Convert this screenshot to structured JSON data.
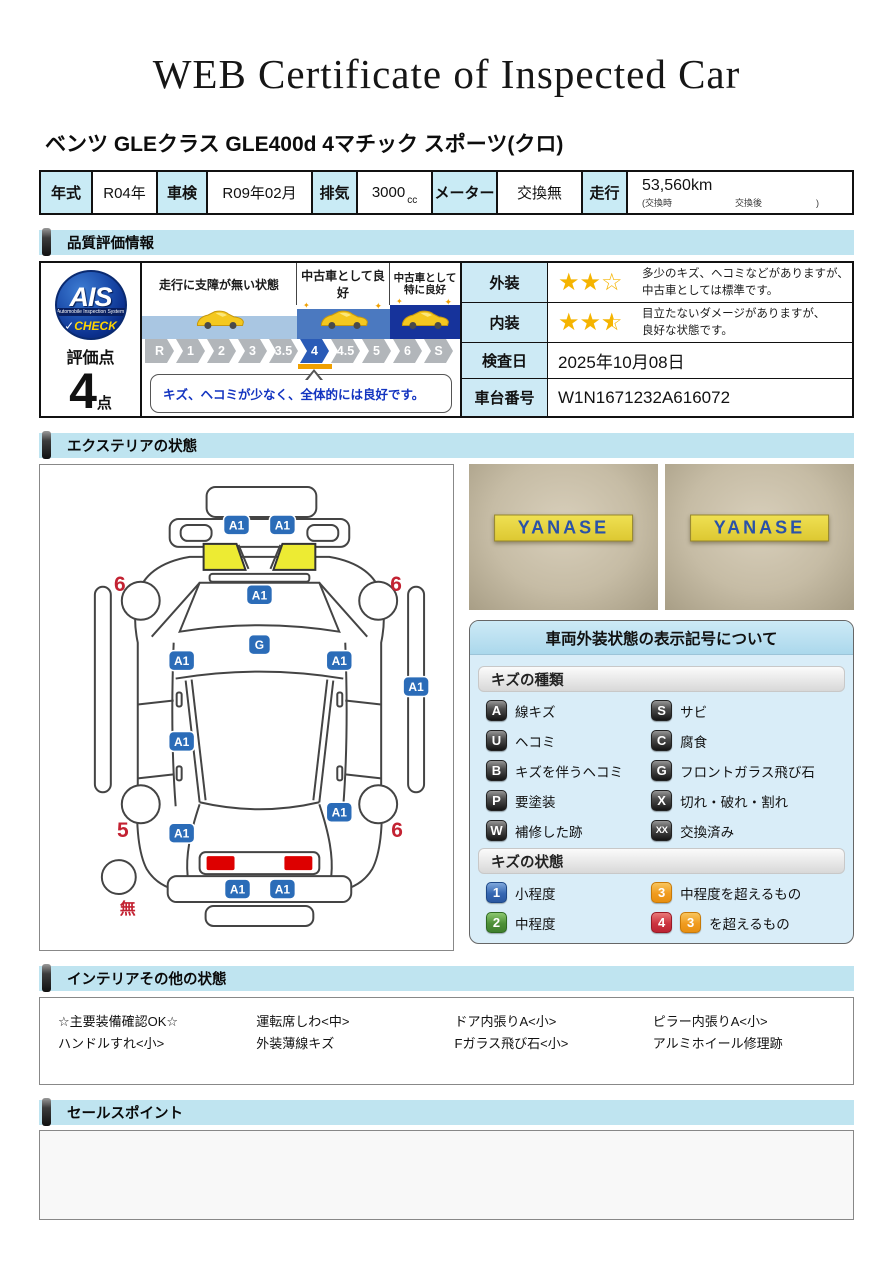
{
  "page": {
    "title": "WEB Certificate of Inspected Car",
    "car_name": "ベンツ GLEクラス GLE400d 4マチック スポーツ(クロ)"
  },
  "spec": {
    "cells": [
      {
        "label": "年式",
        "value": "R04年"
      },
      {
        "label": "車検",
        "value": "R09年02月"
      },
      {
        "label": "排気",
        "value": "3000",
        "unit": "cc"
      },
      {
        "label": "メーター",
        "value": "交換無"
      },
      {
        "label": "走行",
        "value": "53,560km",
        "note": "(交換時　　　　　　　交換後　　　　　　)"
      }
    ]
  },
  "sections": {
    "quality": "品質評価情報",
    "exterior": "エクステリアの状態",
    "interior": "インテリアその他の状態",
    "sales": "セールスポイント"
  },
  "quality": {
    "logo": {
      "main": "AIS",
      "sub": "Automobile Inspection System",
      "checkmark": "✓",
      "check": "CHECK"
    },
    "score_label": "評価点",
    "score_value": "4",
    "score_unit": "点",
    "zones": [
      {
        "label": "走行に支障が無い状態"
      },
      {
        "label": "中古車として良好"
      },
      {
        "label1": "中古車として",
        "label2": "特に良好"
      }
    ],
    "scale": [
      "R",
      "1",
      "2",
      "3",
      "3.5",
      "4",
      "4.5",
      "5",
      "6",
      "S"
    ],
    "scale_active": "4",
    "comment": "キズ、ヘコミが少なく、全体的には良好です。",
    "rows": [
      {
        "label": "外装",
        "stars_filled": 2,
        "stars_empty": 1,
        "text1": "多少のキズ、ヘコミなどがありますが、",
        "text2": "中古車としては標準です。"
      },
      {
        "label": "内装",
        "stars_filled": 2,
        "stars_half": 1,
        "text1": "目立たないダメージがありますが、",
        "text2": "良好な状態です。"
      },
      {
        "label": "検査日",
        "value": "2025年10月08日"
      },
      {
        "label": "車台番号",
        "value": "W1N1671232A616072"
      }
    ]
  },
  "exterior": {
    "photos": {
      "sign": "YANASE"
    },
    "diagram": {
      "badge_a1": "A1",
      "badge_g": "G",
      "wheel_rear_left": "6",
      "wheel_rear_right": "6",
      "wheel_front_left": "5",
      "wheel_front_right": "6",
      "spare": "無"
    },
    "legend": {
      "title": "車両外装状態の表示記号について",
      "kind_header": "キズの種類",
      "kinds": [
        {
          "code": "A",
          "label": "線キズ"
        },
        {
          "code": "S",
          "label": "サビ"
        },
        {
          "code": "U",
          "label": "ヘコミ"
        },
        {
          "code": "C",
          "label": "腐食"
        },
        {
          "code": "B",
          "label": "キズを伴うヘコミ"
        },
        {
          "code": "G",
          "label": "フロントガラス飛び石"
        },
        {
          "code": "P",
          "label": "要塗装"
        },
        {
          "code": "X",
          "label": "切れ・破れ・割れ"
        },
        {
          "code": "W",
          "label": "補修した跡"
        },
        {
          "code": "XX",
          "label": "交換済み"
        }
      ],
      "state_header": "キズの状態",
      "states": [
        {
          "code": "1",
          "variant": "blue",
          "label": "小程度"
        },
        {
          "code": "3",
          "variant": "orange",
          "label": "中程度を超えるもの"
        },
        {
          "code": "2",
          "variant": "green",
          "label": "中程度"
        },
        {
          "code": "4",
          "variant": "red",
          "code2": "3",
          "variant2": "orange",
          "label": "を超えるもの"
        }
      ]
    }
  },
  "interior": {
    "items": [
      "☆主要装備確認OK☆",
      "運転席しわ<中>",
      "ドア内張りA<小>",
      "ピラー内張りA<小>",
      "ハンドルすれ<小>",
      "外装薄線キズ",
      "Fガラス飛び石<小>",
      "アルミホイール修理跡"
    ]
  },
  "sales": {
    "content": ""
  },
  "colors": {
    "section_bar": "#bfe4f0",
    "table_header_cell": "#c9ebf5",
    "marker_blue": "#2b6cb8",
    "scale_active_blue": "#2a5bb7",
    "scale_gray": "#b2b6ba",
    "orange_indicator": "#f0a000",
    "star_gold": "#f5b400",
    "band_light": "#a9c6e2",
    "band_mid": "#4b79c0",
    "band_dark": "#16339b",
    "tail_lamp_yellow": "#edeb33",
    "headlight_red": "#dd0000",
    "wheel_label_red": "#c32232",
    "legend_bg": "#d9edf8",
    "sign_yellow": "#e8d63f",
    "sign_blue": "#2a52a8"
  }
}
